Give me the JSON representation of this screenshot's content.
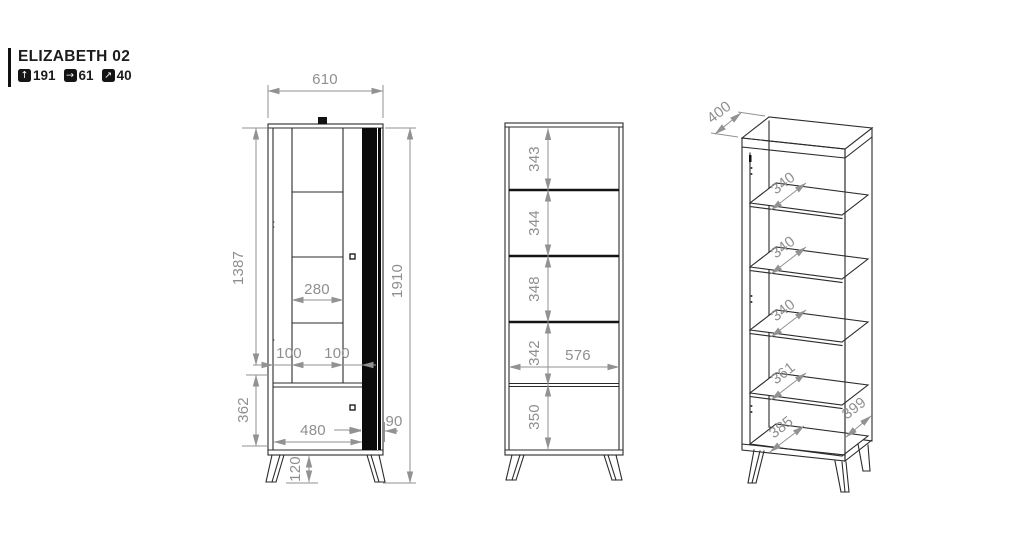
{
  "header": {
    "title": "ELIZABETH 02",
    "metrics": [
      {
        "icon": "height-arrow-up-icon",
        "glyph": "↑",
        "value": "191"
      },
      {
        "icon": "width-arrow-right-icon",
        "glyph": "→",
        "value": "61"
      },
      {
        "icon": "depth-arrow-diagonal-icon",
        "glyph": "↗",
        "value": "40"
      }
    ]
  },
  "colors": {
    "background": "#ffffff",
    "outline": "#2b2b2b",
    "dimension": "#929292",
    "accent_strip": "#0b0b0b"
  },
  "views": {
    "front": {
      "label": "front view closed",
      "dims": {
        "width_top": "610",
        "glass_height": "1387",
        "total_height": "1910",
        "glass_width": "280",
        "gap_left": "100",
        "gap_right": "100",
        "bottom_height": "362",
        "bottom_width": "480",
        "strip_width": "90",
        "leg_height": "120"
      }
    },
    "open": {
      "label": "front view open",
      "dims": {
        "section_1": "343",
        "section_2": "344",
        "section_3": "348",
        "section_4": "342",
        "section_5": "350",
        "inner_width": "576"
      }
    },
    "iso": {
      "label": "perspective view",
      "dims": {
        "top_depth": "400",
        "shelf_1": "340",
        "shelf_2": "340",
        "shelf_3": "340",
        "shelf_4": "361",
        "bottom_depth": "385",
        "side_depth": "399"
      }
    }
  }
}
